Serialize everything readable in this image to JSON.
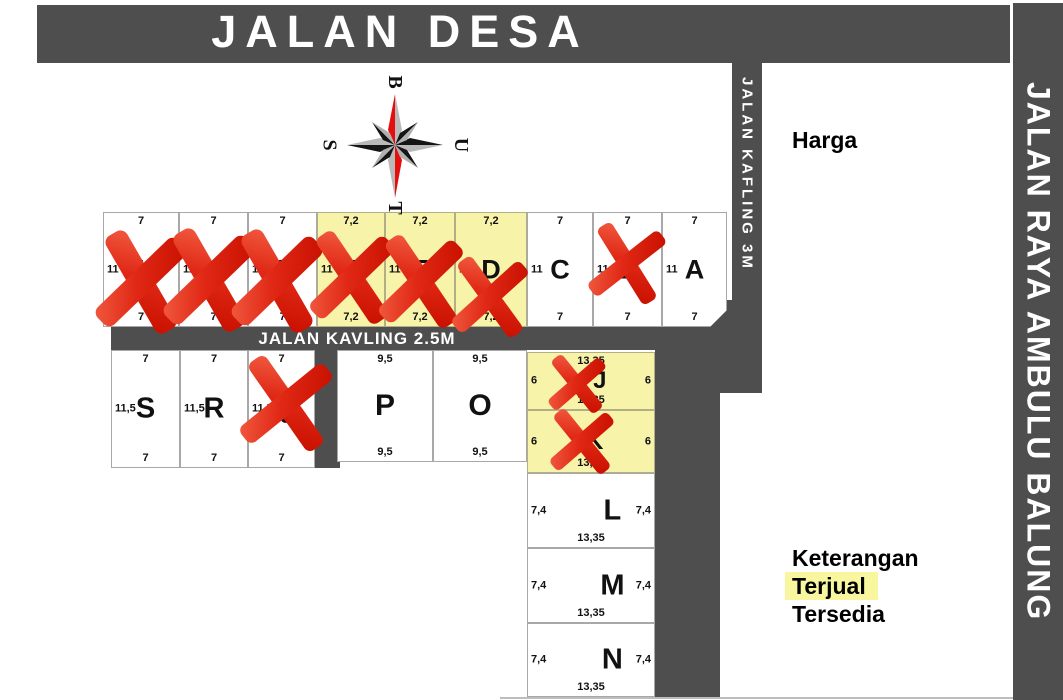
{
  "roads": {
    "jalan_desa": "JALAN DESA",
    "jalan_raya": "JALAN RAYA AMBULU BALUNG",
    "jalan_kafling": "JALAN KAFLING 3M",
    "jalan_kavling": "JALAN KAVLING 2.5M"
  },
  "panel": {
    "price_label": "Harga"
  },
  "legend": {
    "heading": "Keterangan",
    "sold_label": "Terjual",
    "available_label": "Tersedia"
  },
  "compass": {
    "top": "B",
    "right": "U",
    "bottom": "T",
    "left": "S"
  },
  "colors": {
    "road": "#4e4e4e",
    "plot_available_fill": "#ffffff",
    "plot_sold_fill": "#f7f3a9",
    "cross_red": "#e02815",
    "legend_highlight": "#f9f6a0"
  },
  "plots": [
    {
      "id": "I",
      "letter": "I",
      "x": 103,
      "y": 212,
      "w": 76,
      "h": 115,
      "fill": "white",
      "crossed": true,
      "ls": 27,
      "dims": {
        "top": "7",
        "bottom": "7",
        "left": "11"
      }
    },
    {
      "id": "H",
      "letter": "H",
      "x": 179,
      "y": 212,
      "w": 69,
      "h": 115,
      "fill": "white",
      "crossed": true,
      "ls": 27,
      "dims": {
        "top": "7",
        "bottom": "7",
        "left": "11"
      }
    },
    {
      "id": "G",
      "letter": "G",
      "x": 248,
      "y": 212,
      "w": 69,
      "h": 115,
      "fill": "white",
      "crossed": true,
      "ls": 27,
      "dims": {
        "top": "7",
        "bottom": "7",
        "left": "11"
      }
    },
    {
      "id": "F",
      "letter": "F",
      "x": 317,
      "y": 212,
      "w": 68,
      "h": 115,
      "fill": "yellow",
      "crossed": true,
      "ls": 27,
      "dims": {
        "top": "7,2",
        "bottom": "7,2",
        "left": "11"
      }
    },
    {
      "id": "E",
      "letter": "E",
      "x": 385,
      "y": 212,
      "w": 70,
      "h": 115,
      "fill": "yellow",
      "crossed": true,
      "ls": 27,
      "dims": {
        "top": "7,2",
        "bottom": "7,2",
        "left": "11"
      }
    },
    {
      "id": "D",
      "letter": "D",
      "x": 455,
      "y": 212,
      "w": 72,
      "h": 115,
      "fill": "yellow",
      "crossed": true,
      "ls": 27,
      "dims": {
        "top": "7,2",
        "bottom": "7,2",
        "left": "11"
      }
    },
    {
      "id": "C",
      "letter": "C",
      "x": 527,
      "y": 212,
      "w": 66,
      "h": 115,
      "fill": "white",
      "crossed": false,
      "ls": 27,
      "dims": {
        "top": "7",
        "bottom": "7",
        "left": "11"
      }
    },
    {
      "id": "B",
      "letter": "B",
      "x": 593,
      "y": 212,
      "w": 69,
      "h": 115,
      "fill": "white",
      "crossed": true,
      "ls": 27,
      "dims": {
        "top": "7",
        "bottom": "7",
        "left": "11"
      }
    },
    {
      "id": "A",
      "letter": "A",
      "x": 662,
      "y": 212,
      "w": 65,
      "h": 115,
      "fill": "white",
      "crossed": false,
      "chamfer": true,
      "ls": 27,
      "dims": {
        "top": "7",
        "bottom": "7",
        "left": "11"
      }
    },
    {
      "id": "S",
      "letter": "S",
      "x": 111,
      "y": 350,
      "w": 69,
      "h": 118,
      "fill": "white",
      "crossed": false,
      "ls": 29,
      "dims": {
        "top": "7",
        "bottom": "7",
        "left": "11,5"
      }
    },
    {
      "id": "R",
      "letter": "R",
      "x": 180,
      "y": 350,
      "w": 68,
      "h": 118,
      "fill": "white",
      "crossed": false,
      "ls": 29,
      "dims": {
        "top": "7",
        "bottom": "7",
        "left": "11,5"
      }
    },
    {
      "id": "Q",
      "letter": "Q",
      "x": 248,
      "y": 350,
      "w": 67,
      "h": 118,
      "fill": "white",
      "crossed": true,
      "ls": 27,
      "dims": {
        "top": "7",
        "bottom": "7",
        "left": "11,5"
      }
    },
    {
      "id": "P",
      "letter": "P",
      "x": 337,
      "y": 350,
      "w": 96,
      "h": 112,
      "fill": "white",
      "crossed": false,
      "ls": 30,
      "dims": {
        "top": "9,5",
        "bottom": "9,5"
      }
    },
    {
      "id": "O",
      "letter": "O",
      "x": 433,
      "y": 350,
      "w": 94,
      "h": 112,
      "fill": "white",
      "crossed": false,
      "ls": 30,
      "dims": {
        "top": "9,5",
        "bottom": "9,5"
      }
    },
    {
      "id": "J",
      "letter": "J",
      "x": 527,
      "y": 352,
      "w": 128,
      "h": 58,
      "fill": "yellow",
      "crossed": true,
      "ls": 24,
      "lx": 0.57,
      "dims": {
        "top": "13,35",
        "bottom": "13,35",
        "left": "6",
        "right": "6"
      }
    },
    {
      "id": "K",
      "letter": "K",
      "x": 527,
      "y": 410,
      "w": 128,
      "h": 63,
      "fill": "yellow",
      "crossed": true,
      "ls": 24,
      "lx": 0.53,
      "dims": {
        "bottom": "13,35",
        "left": "6",
        "right": "6"
      }
    },
    {
      "id": "L",
      "letter": "L",
      "x": 527,
      "y": 473,
      "w": 128,
      "h": 75,
      "fill": "white",
      "crossed": false,
      "ls": 29,
      "lx": 0.67,
      "dims": {
        "bottom": "13,35",
        "left": "7,4",
        "right": "7,4"
      }
    },
    {
      "id": "M",
      "letter": "M",
      "x": 527,
      "y": 548,
      "w": 128,
      "h": 75,
      "fill": "white",
      "crossed": false,
      "ls": 29,
      "lx": 0.67,
      "dims": {
        "bottom": "13,35",
        "left": "7,4",
        "right": "7,4"
      }
    },
    {
      "id": "N",
      "letter": "N",
      "x": 527,
      "y": 623,
      "w": 128,
      "h": 74,
      "fill": "white",
      "crossed": false,
      "ls": 29,
      "lx": 0.67,
      "dims": {
        "bottom": "13,35",
        "left": "7,4",
        "right": "7,4"
      }
    }
  ],
  "crosses": [
    {
      "plot": "I",
      "cx": 141,
      "cy": 282,
      "len": 112,
      "th": 24,
      "ang": 52,
      "rot": 8
    },
    {
      "plot": "H",
      "cx": 209,
      "cy": 280,
      "len": 112,
      "th": 24,
      "ang": 52,
      "rot": 8
    },
    {
      "plot": "G",
      "cx": 277,
      "cy": 281,
      "len": 112,
      "th": 24,
      "ang": 52,
      "rot": 8
    },
    {
      "plot": "F",
      "cx": 352,
      "cy": 277,
      "len": 104,
      "th": 21,
      "ang": 50,
      "rot": 6
    },
    {
      "plot": "E",
      "cx": 421,
      "cy": 281,
      "len": 104,
      "th": 21,
      "ang": 50,
      "rot": 6
    },
    {
      "plot": "D",
      "cx": 490,
      "cy": 297,
      "len": 92,
      "th": 18,
      "ang": 48,
      "rot": 6
    },
    {
      "plot": "B",
      "cx": 627,
      "cy": 263,
      "len": 90,
      "th": 17,
      "ang": 48,
      "rot": 10
    },
    {
      "plot": "Q",
      "cx": 286,
      "cy": 403,
      "len": 108,
      "th": 21,
      "ang": 47,
      "rot": 8
    },
    {
      "plot": "J",
      "cx": 577,
      "cy": 384,
      "len": 68,
      "th": 14,
      "ang": 46,
      "rot": 5
    },
    {
      "plot": "K",
      "cx": 582,
      "cy": 441,
      "len": 76,
      "th": 15,
      "ang": 46,
      "rot": 5
    }
  ]
}
